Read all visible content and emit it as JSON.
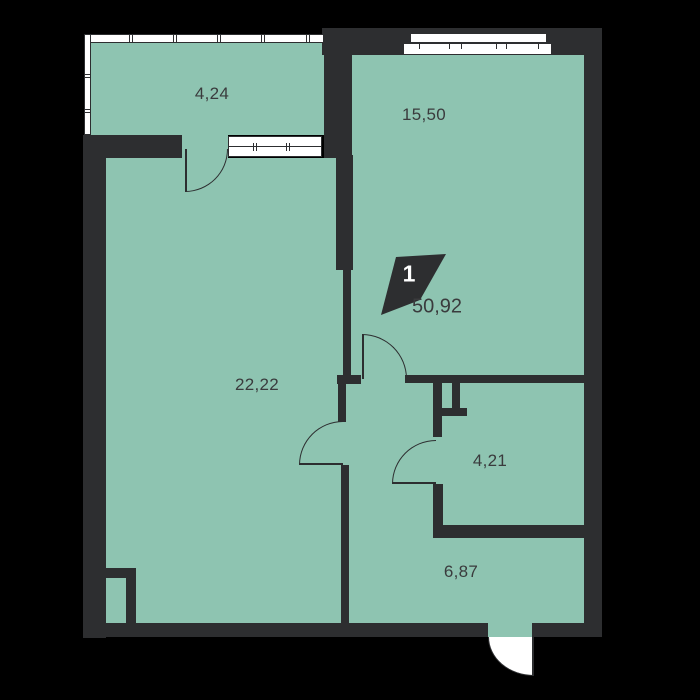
{
  "colors": {
    "background": "#000000",
    "floor": "#8ec4b1",
    "wall": "#2d2e30",
    "window": "#ffffff",
    "label": "#3a3b3d"
  },
  "plan": {
    "badge": {
      "rooms": "1",
      "total_area": "50,92"
    },
    "rooms": [
      {
        "id": "balcony",
        "area": "4,24"
      },
      {
        "id": "living-room",
        "area": "15,50"
      },
      {
        "id": "main-room",
        "area": "22,22"
      },
      {
        "id": "bathroom",
        "area": "4,21"
      },
      {
        "id": "hallway",
        "area": "6,87"
      }
    ]
  }
}
